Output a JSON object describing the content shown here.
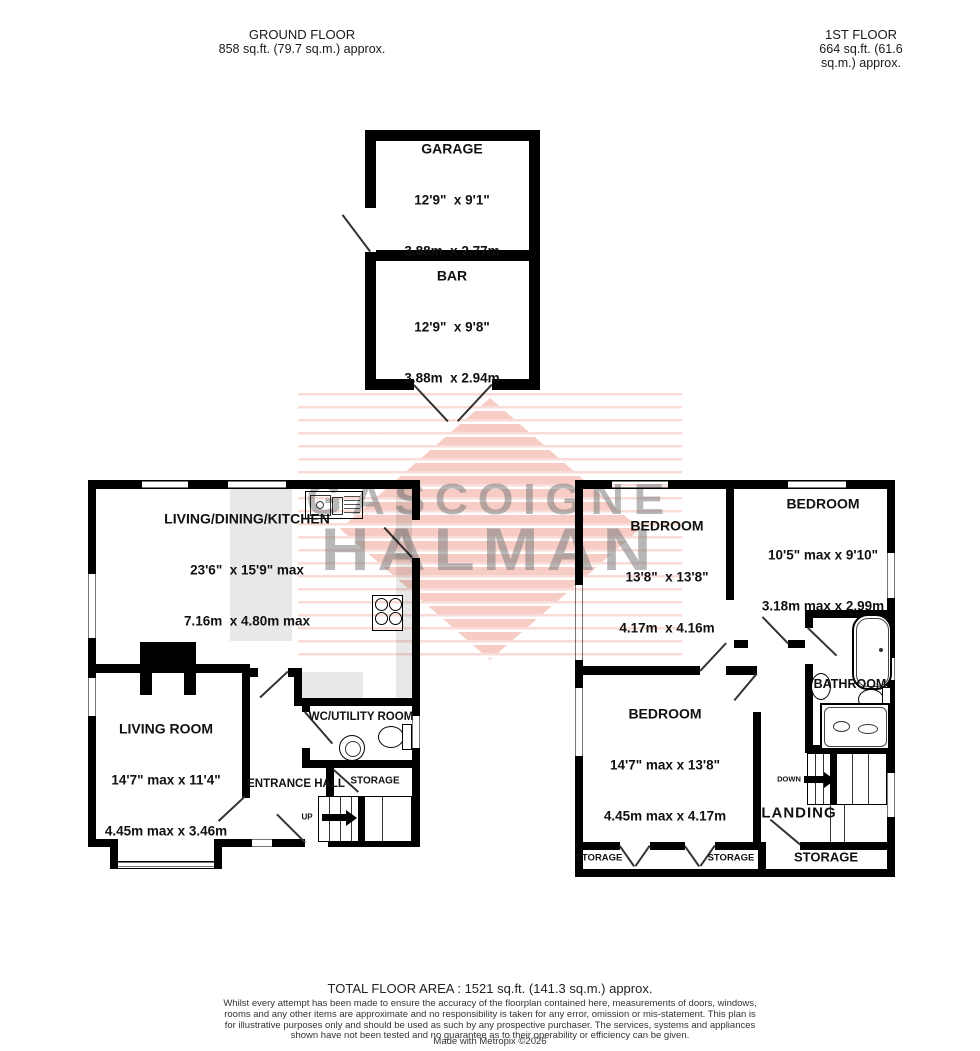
{
  "headers": {
    "ground": {
      "title": "GROUND FLOOR",
      "area": "858 sq.ft. (79.7 sq.m.) approx."
    },
    "first": {
      "title": "1ST FLOOR",
      "area": "664 sq.ft. (61.6 sq.m.) approx."
    }
  },
  "outbuilding": {
    "garage": {
      "name": "GARAGE",
      "imperial": "12'9\"  x 9'1\"",
      "metric": "3.88m  x 2.77m"
    },
    "bar": {
      "name": "BAR",
      "imperial": "12'9\"  x 9'8\"",
      "metric": "3.88m  x 2.94m"
    }
  },
  "ground_floor": {
    "ldk": {
      "name": "LIVING/DINING/KITCHEN",
      "imperial": "23'6\"  x 15'9\" max",
      "metric": "7.16m  x 4.80m max"
    },
    "living_room": {
      "name": "LIVING ROOM",
      "imperial": "14'7\" max x 11'4\"",
      "metric": "4.45m max x 3.46m"
    },
    "entrance_hall": {
      "label": "ENTRANCE HALL"
    },
    "wc_utility": {
      "label": "WC/UTILITY ROOM"
    },
    "storage": {
      "label": "STORAGE"
    },
    "stairs": {
      "label": "UP"
    }
  },
  "first_floor": {
    "bedroom1": {
      "name": "BEDROOM",
      "imperial": "13'8\"  x 13'8\"",
      "metric": "4.17m  x 4.16m"
    },
    "bedroom2": {
      "name": "BEDROOM",
      "imperial": "10'5\" max x 9'10\"",
      "metric": "3.18m max x 2.99m"
    },
    "bedroom3": {
      "name": "BEDROOM",
      "imperial": "14'7\" max x 13'8\"",
      "metric": "4.45m max x 4.17m"
    },
    "bathroom": {
      "label": "BATHROOM"
    },
    "landing": {
      "label": "LANDING"
    },
    "stairs": {
      "label": "DOWN"
    },
    "storage_labels": [
      "STORAGE",
      "STORAGE",
      "STORAGE"
    ]
  },
  "watermark": {
    "line1": "GASCOIGNE",
    "line2": "HALMAN",
    "stripe_color": "#e45f48",
    "text_color": "#7d7d7d"
  },
  "footer": {
    "total": "TOTAL FLOOR AREA : 1521 sq.ft. (141.3 sq.m.) approx.",
    "disclaimer": "Whilst every attempt has been made to ensure the accuracy of the floorplan contained here, measurements of doors, windows, rooms and any other items are approximate and no responsibility is taken for any error, omission or mis-statement. This plan is for illustrative purposes only and should be used as such by any prospective purchaser. The services, systems and appliances shown have not been tested and no guarantee as to their operability or efficiency can be given.",
    "credit": "Made with Metropix ©2026"
  },
  "colors": {
    "wall": "#000000",
    "shade": "#e8e8e8"
  }
}
